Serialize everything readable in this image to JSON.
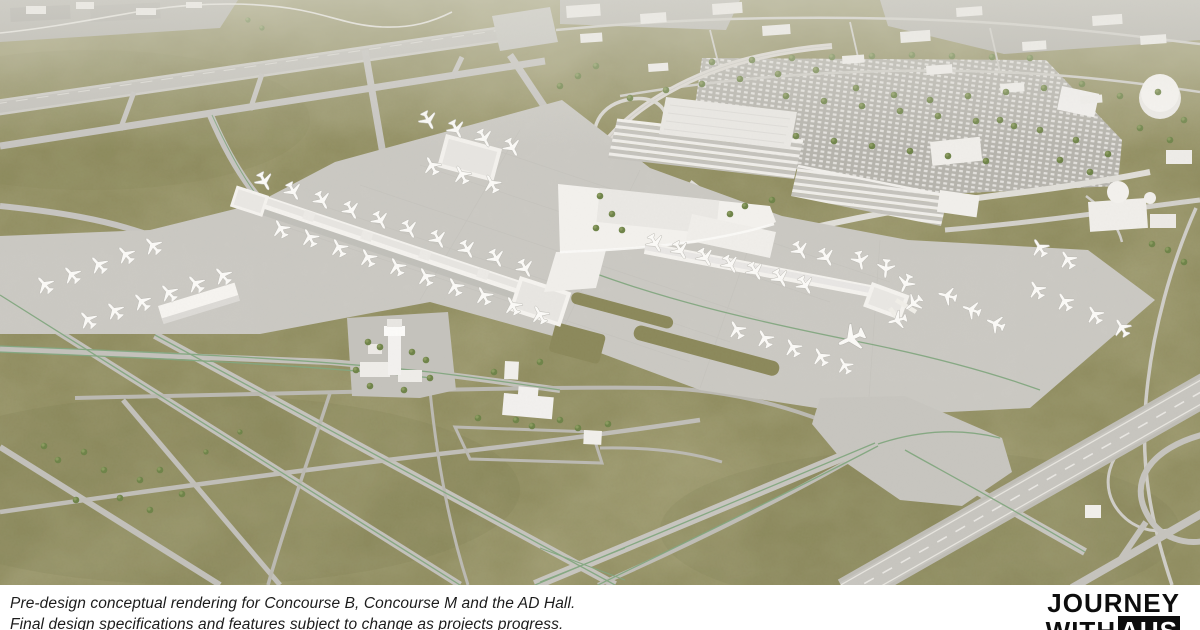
{
  "card": {
    "width": 1200,
    "height": 630
  },
  "scene": {
    "description": "Aerial 3D pre-design conceptual rendering of an airport campus: a long new gate concourse and an existing terminal with a second concourse, white aircraft parked at gates and on remote stands, parking garages and a large surface parking lot with rows of trees, a control tower compound, and diagonal runways, taxiways and service roads with green guidance lines crossing mowed olive-green grass fields."
  },
  "caption": {
    "line1": "Pre-design conceptual rendering for Concourse B, Concourse M and the AD Hall.",
    "line2": "Final design specifications and features subject to change as projects progress."
  },
  "logo": {
    "line1": "JOURNEY",
    "line2_word": "WITH",
    "line2_brand": "AUS"
  },
  "palette": {
    "grass": "#908d60",
    "grass_shadow": "#7b7b4f",
    "pavement": "#cbc9c3",
    "runway": "#c2c0ba",
    "building": "#f4f2ee",
    "building_roof": "#e6e4e0",
    "tree": "#6e8348",
    "guideline_green": "#82a77f",
    "caption_bar": "#ffffff",
    "caption_text": "#1c1c1c",
    "logo_black": "#0d0d0d"
  }
}
